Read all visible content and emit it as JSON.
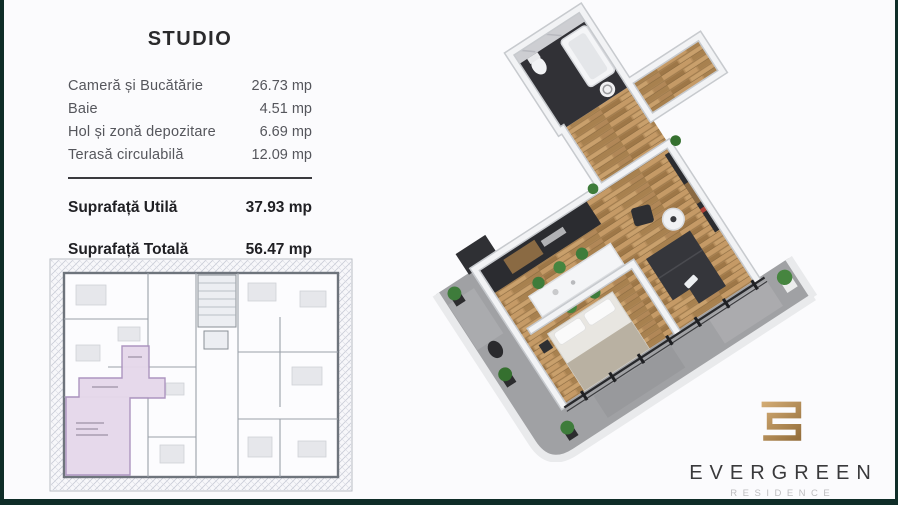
{
  "slide": {
    "background": "#fbfbfd",
    "frame_color": "#0f2d28"
  },
  "unit_card": {
    "title": "STUDIO",
    "rows": [
      {
        "label": "Cameră și Bucătărie",
        "value": "26.73 mp"
      },
      {
        "label": "Baie",
        "value": "4.51 mp"
      },
      {
        "label": "Hol și zonă depozitare",
        "value": "6.69 mp"
      },
      {
        "label": "Terasă circulabilă",
        "value": "12.09 mp"
      }
    ],
    "totals": [
      {
        "label": "Suprafață Utilă",
        "value": "37.93 mp"
      },
      {
        "label": "Suprafață Totală",
        "value": "56.47 mp"
      }
    ]
  },
  "floorplans": {
    "plan2d": {
      "description": "building level plan with studio unit highlighted",
      "highlight_color": "#e5d8eb"
    },
    "plan3d": {
      "description": "isometric 3D render of the studio apartment",
      "wood_color": "#b78e5c",
      "terrace_color": "#a0a1a4",
      "wall_color": "#f2f3f5",
      "dark_furniture_color": "#2c2d31",
      "plant_color": "#3e7c3b"
    }
  },
  "brand": {
    "logo_icon": "gold-meander-monogram",
    "name": "EVERGREEN",
    "subtitle": "RESIDENCE",
    "gold": "#b9905a",
    "name_color": "#39393b",
    "subtitle_color": "#bdbdbf"
  }
}
